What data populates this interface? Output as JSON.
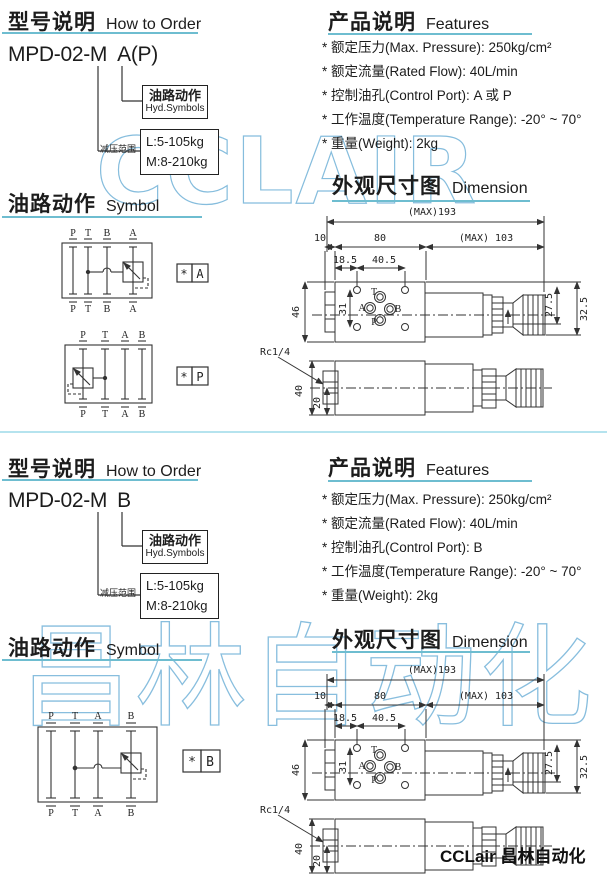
{
  "colors": {
    "underline": "#6ebdd0",
    "divider": "#b5e3ee",
    "watermark": "#88bede",
    "ink": "#1c1c1c"
  },
  "watermarks": {
    "top": "CCLAIR",
    "bottom": "昌林自动化"
  },
  "footer": "CCLair 昌林自动化",
  "pages": [
    {
      "order": {
        "title_zh": "型号说明",
        "title_en": "How to Order",
        "model": "MPD-02-M",
        "variant": "A(P)",
        "hyd_zh": "油路动作",
        "hyd_en": "Hyd.Symbols",
        "range_label": "减压范围",
        "range_l": "L:5-105kg",
        "range_m": "M:8-210kg"
      },
      "features": {
        "title_zh": "产品说明",
        "title_en": "Features",
        "items": [
          "* 额定压力(Max. Pressure): 250kg/cm²",
          "* 额定流量(Rated Flow): 40L/min",
          "* 控制油孔(Control Port): A 或 P",
          "* 工作温度(Temperature Range): -20° ~ 70°",
          "* 重量(Weight): 2kg"
        ]
      },
      "symbol": {
        "title_zh": "油路动作",
        "title_en": "Symbol",
        "diagrams": [
          {
            "ports": [
              "P",
              "T",
              "B",
              "A"
            ],
            "star": "*",
            "label": "A"
          },
          {
            "ports": [
              "P",
              "T",
              "A",
              "B"
            ],
            "star": "*",
            "label": "P"
          }
        ]
      },
      "dimension": {
        "title_zh": "外观尺寸图",
        "title_en": "Dimension",
        "overall": "(MAX)193",
        "len10": "10",
        "len80": "80",
        "len103": "(MAX) 103",
        "hole1": "18.5",
        "hole2": "40.5",
        "height": "46",
        "face": "31",
        "r1": "27.5",
        "r2": "32.5",
        "b1": "40",
        "b2": "20",
        "thread": "Rc1/4",
        "portT": "T",
        "portA": "A",
        "portB": "B",
        "portP": "P"
      }
    },
    {
      "order": {
        "title_zh": "型号说明",
        "title_en": "How to Order",
        "model": "MPD-02-M",
        "variant": "B",
        "hyd_zh": "油路动作",
        "hyd_en": "Hyd.Symbols",
        "range_label": "减压范围",
        "range_l": "L:5-105kg",
        "range_m": "M:8-210kg"
      },
      "features": {
        "title_zh": "产品说明",
        "title_en": "Features",
        "items": [
          "* 额定压力(Max. Pressure): 250kg/cm²",
          "* 额定流量(Rated Flow): 40L/min",
          "* 控制油孔(Control Port): B",
          "* 工作温度(Temperature Range): -20° ~ 70°",
          "* 重量(Weight): 2kg"
        ]
      },
      "symbol": {
        "title_zh": "油路动作",
        "title_en": "Symbol",
        "diagrams": [
          {
            "ports": [
              "P",
              "T",
              "A",
              "B"
            ],
            "star": "*",
            "label": "B"
          }
        ]
      },
      "dimension": {
        "title_zh": "外观尺寸图",
        "title_en": "Dimension",
        "overall": "(MAX)193",
        "len10": "10",
        "len80": "80",
        "len103": "(MAX) 103",
        "hole1": "18.5",
        "hole2": "40.5",
        "height": "46",
        "face": "31",
        "r1": "27.5",
        "r2": "32.5",
        "b1": "40",
        "b2": "20",
        "thread": "Rc1/4",
        "portT": "T",
        "portA": "A",
        "portB": "B",
        "portP": "P"
      }
    }
  ]
}
